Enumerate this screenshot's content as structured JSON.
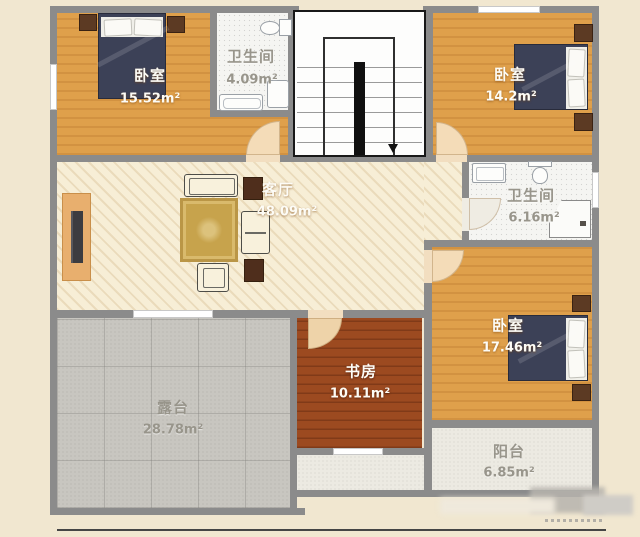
{
  "rooms": {
    "bedroom_tl": {
      "label": "卧室",
      "area": "15.52m²"
    },
    "bathroom_top": {
      "label": "卫生间",
      "area": "4.09m²"
    },
    "bedroom_tr": {
      "label": "卧室",
      "area": "14.2m²"
    },
    "living": {
      "label": "客厅",
      "area": "48.09m²"
    },
    "bathroom_right": {
      "label": "卫生间",
      "area": "6.16m²"
    },
    "bedroom_br": {
      "label": "卧室",
      "area": "17.46m²"
    },
    "study": {
      "label": "书房",
      "area": "10.11m²"
    },
    "terrace": {
      "label": "露台",
      "area": "28.78m²"
    },
    "balcony": {
      "label": "阳台",
      "area": "6.85m²"
    }
  },
  "colors": {
    "background": "#f1e7d0",
    "wall": "#8b8b8b",
    "bedroom_floor": "#dfa04b",
    "living_floor": "#f7eed6",
    "study_floor": "#9c4a20",
    "terrace_floor": "#c8c6c0",
    "balcony_floor": "#eceae2",
    "bathroom_floor": "#f5f5f2",
    "bed_blanket": "#3c4157",
    "nightstand": "#5c3a23",
    "rug": "#c7a34c",
    "door_swing": "#f4dcb8",
    "stairs_ink": "#181818"
  }
}
